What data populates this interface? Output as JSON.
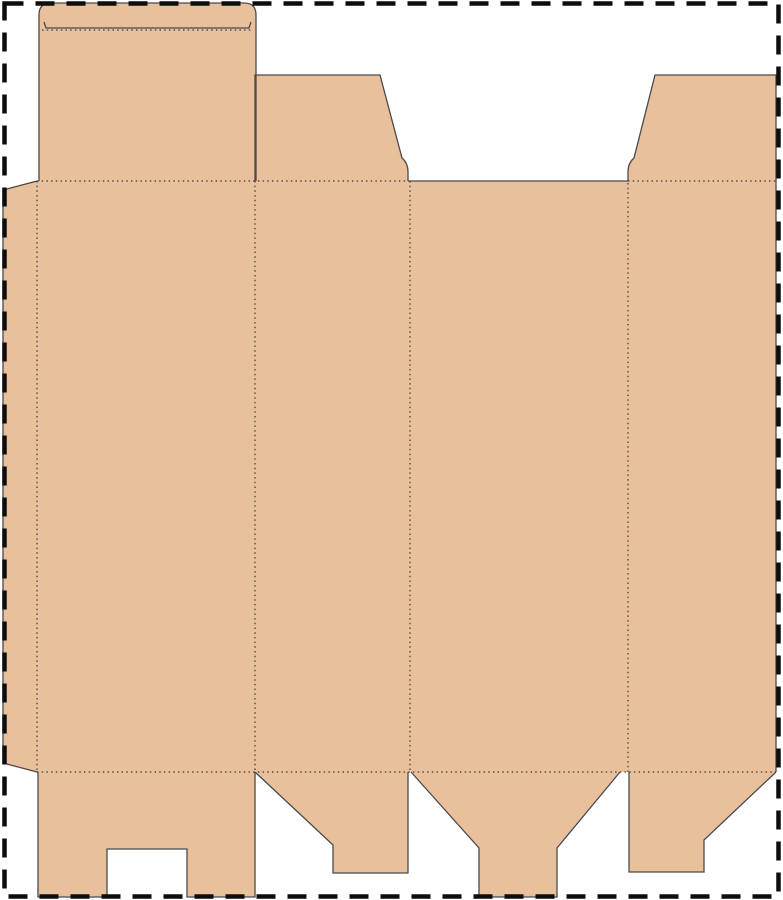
{
  "canvas": {
    "width": 783,
    "height": 900,
    "background": "#ffffff"
  },
  "palette": {
    "board_fill": "#E9C09C",
    "cut_line": "#4a4a4a",
    "fold_line": "#3a3a3a",
    "page_border": "#0d0d0d"
  },
  "page_border": {
    "x": 4.5,
    "y": 3.5,
    "width": 774,
    "height": 893,
    "stroke_width": 4.5,
    "dash": "19 12"
  },
  "dieline": {
    "fill_shapes": [
      {
        "name": "glue-flap",
        "d": "M37,181 L3,190 L3,763 L37,772 Z"
      },
      {
        "name": "tuck-flap-and-lid",
        "d": "M39,181 L39,15 Q39,3 51,3 L244,3 Q256,3 256,15 L256,181 Z"
      },
      {
        "name": "dust-flap-left",
        "d": "M255,75 L380,75 L402,158 Q408,163 408,172 L408,181 L255,181 Z"
      },
      {
        "name": "dust-flap-right",
        "d": "M655,75 L776,75 L776,181 L628,181 L628,172 Q628,163 634,158 Z"
      },
      {
        "name": "main-body-panels",
        "d": "M37,181 L776,181 L776,772 L37,772 Z"
      },
      {
        "name": "bottom-flap-1",
        "d": "M38,772 L255,772 L255,897 L187,897 L187,849 L107,849 L107,897 L38,897 Z"
      },
      {
        "name": "bottom-flap-2",
        "d": "M255,772 L408,772 L408,873 L333,873 L333,845 Z"
      },
      {
        "name": "bottom-flap-3",
        "d": "M411,772 L620,772 L557,848 L557,897 L479,897 L479,848 Z"
      },
      {
        "name": "bottom-flap-4",
        "d": "M629,772 L776,772 L704,840 L704,872 L629,872 Z"
      }
    ],
    "cut_lines": [
      {
        "name": "glue-flap-cut",
        "d": "M37,181 L3,190 L3,763 L37,772"
      },
      {
        "name": "tuck-flap-cut",
        "d": "M39,181 L39,15 Q39,3 51,3 L244,3 Q256,3 256,15 L256,181"
      },
      {
        "name": "tuck-slit-cut",
        "d": "M44,22 L46,28 L249,28 L251,22"
      },
      {
        "name": "dust-flap-left-cut",
        "d": "M255,181 L255,75 L380,75 L402,158 Q408,163 408,172 L408,181"
      },
      {
        "name": "panel3-top-cut",
        "d": "M408,181 L628,181"
      },
      {
        "name": "dust-flap-right-cut",
        "d": "M628,181 L628,172 Q628,163 634,158 L655,75 L776,75 L776,181"
      },
      {
        "name": "right-edge-cut",
        "d": "M776,181 L776,772"
      },
      {
        "name": "bottom-flap-1-cut",
        "d": "M38,772 L38,897 L107,897 L107,849 L187,849 L187,897 L255,897 L255,772"
      },
      {
        "name": "bottom-flap-2-cut",
        "d": "M255,772 L333,845 L333,873 L408,873 L408,772"
      },
      {
        "name": "bottom-flap-3-cut",
        "d": "M411,772 L479,848 L479,897 L557,897 L557,848 L620,772"
      },
      {
        "name": "bottom-flap-4-cut",
        "d": "M629,772 L629,872 L704,872 L704,840 L776,772"
      }
    ],
    "fold_lines": [
      {
        "name": "tuck-fold",
        "d": "M42,30 L253,30"
      },
      {
        "name": "top-fold-left",
        "d": "M37,181 L408,181"
      },
      {
        "name": "top-fold-right",
        "d": "M628,181 L776,181"
      },
      {
        "name": "bottom-fold",
        "d": "M37,772 L776,772"
      },
      {
        "name": "glue-fold",
        "d": "M37,181 L37,772"
      },
      {
        "name": "panel-fold-1",
        "d": "M255,181 L255,772"
      },
      {
        "name": "panel-fold-2",
        "d": "M410,181 L410,772"
      },
      {
        "name": "panel-fold-3",
        "d": "M628,183 L628,772"
      }
    ],
    "cut_stroke_width": 1.3,
    "fold_stroke_width": 1.2,
    "fold_dash": "1.5 3.2"
  }
}
